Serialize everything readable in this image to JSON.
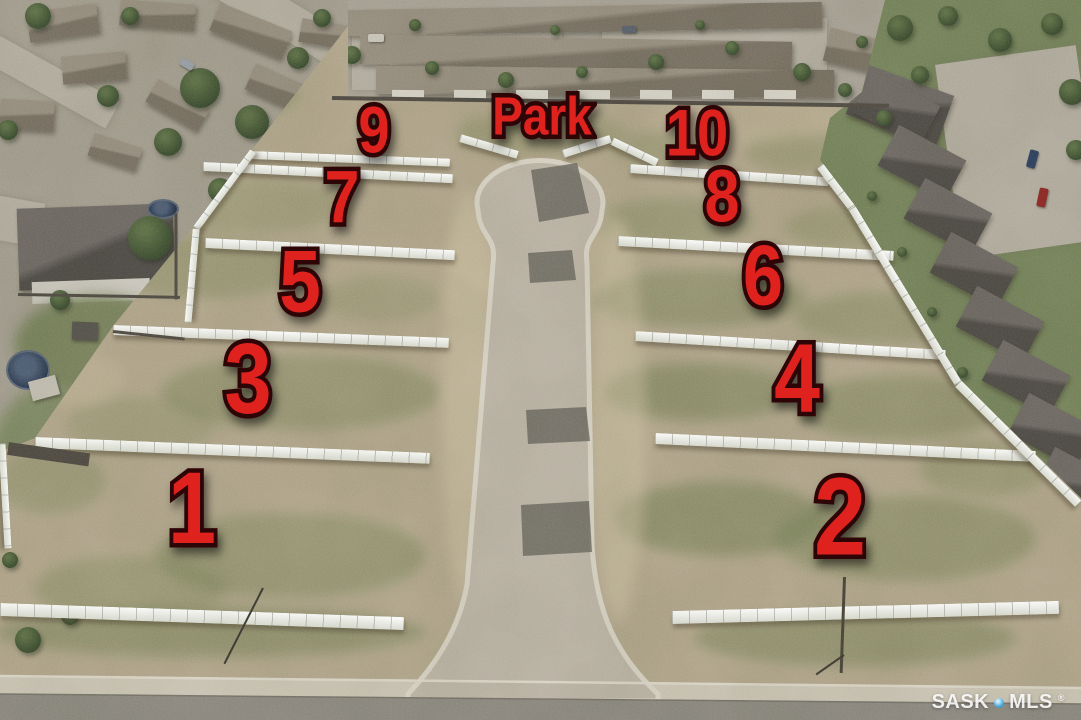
{
  "scene": {
    "park_label": "Park",
    "park": {
      "x": 542,
      "y": 119,
      "font": 54
    },
    "lots": [
      {
        "number": "9",
        "x": 374,
        "y": 133,
        "font": 66
      },
      {
        "number": "7",
        "x": 342,
        "y": 201,
        "font": 74
      },
      {
        "number": "5",
        "x": 300,
        "y": 286,
        "font": 88
      },
      {
        "number": "3",
        "x": 248,
        "y": 384,
        "font": 100
      },
      {
        "number": "1",
        "x": 192,
        "y": 513,
        "font": 102
      },
      {
        "number": "10",
        "x": 697,
        "y": 136,
        "font": 66
      },
      {
        "number": "8",
        "x": 722,
        "y": 200,
        "font": 74
      },
      {
        "number": "6",
        "x": 763,
        "y": 280,
        "font": 85
      },
      {
        "number": "4",
        "x": 797,
        "y": 383,
        "font": 97
      },
      {
        "number": "2",
        "x": 840,
        "y": 523,
        "font": 110
      }
    ]
  },
  "watermark": {
    "brand_left": "SASK",
    "brand_right": "MLS",
    "registered": "®",
    "dot_color": "#4aa6d8"
  },
  "colors": {
    "label_red": "#e0221f",
    "label_outline": "#2e0506",
    "dirt": "#b2a68c",
    "grass": "#6e7c51",
    "road_concrete": "#bcb4a6",
    "curb": "#d8d2c5",
    "asphalt": "#8c8880",
    "sidewalk": "#cbc4b5",
    "fence_white": "#f4f4ef"
  }
}
